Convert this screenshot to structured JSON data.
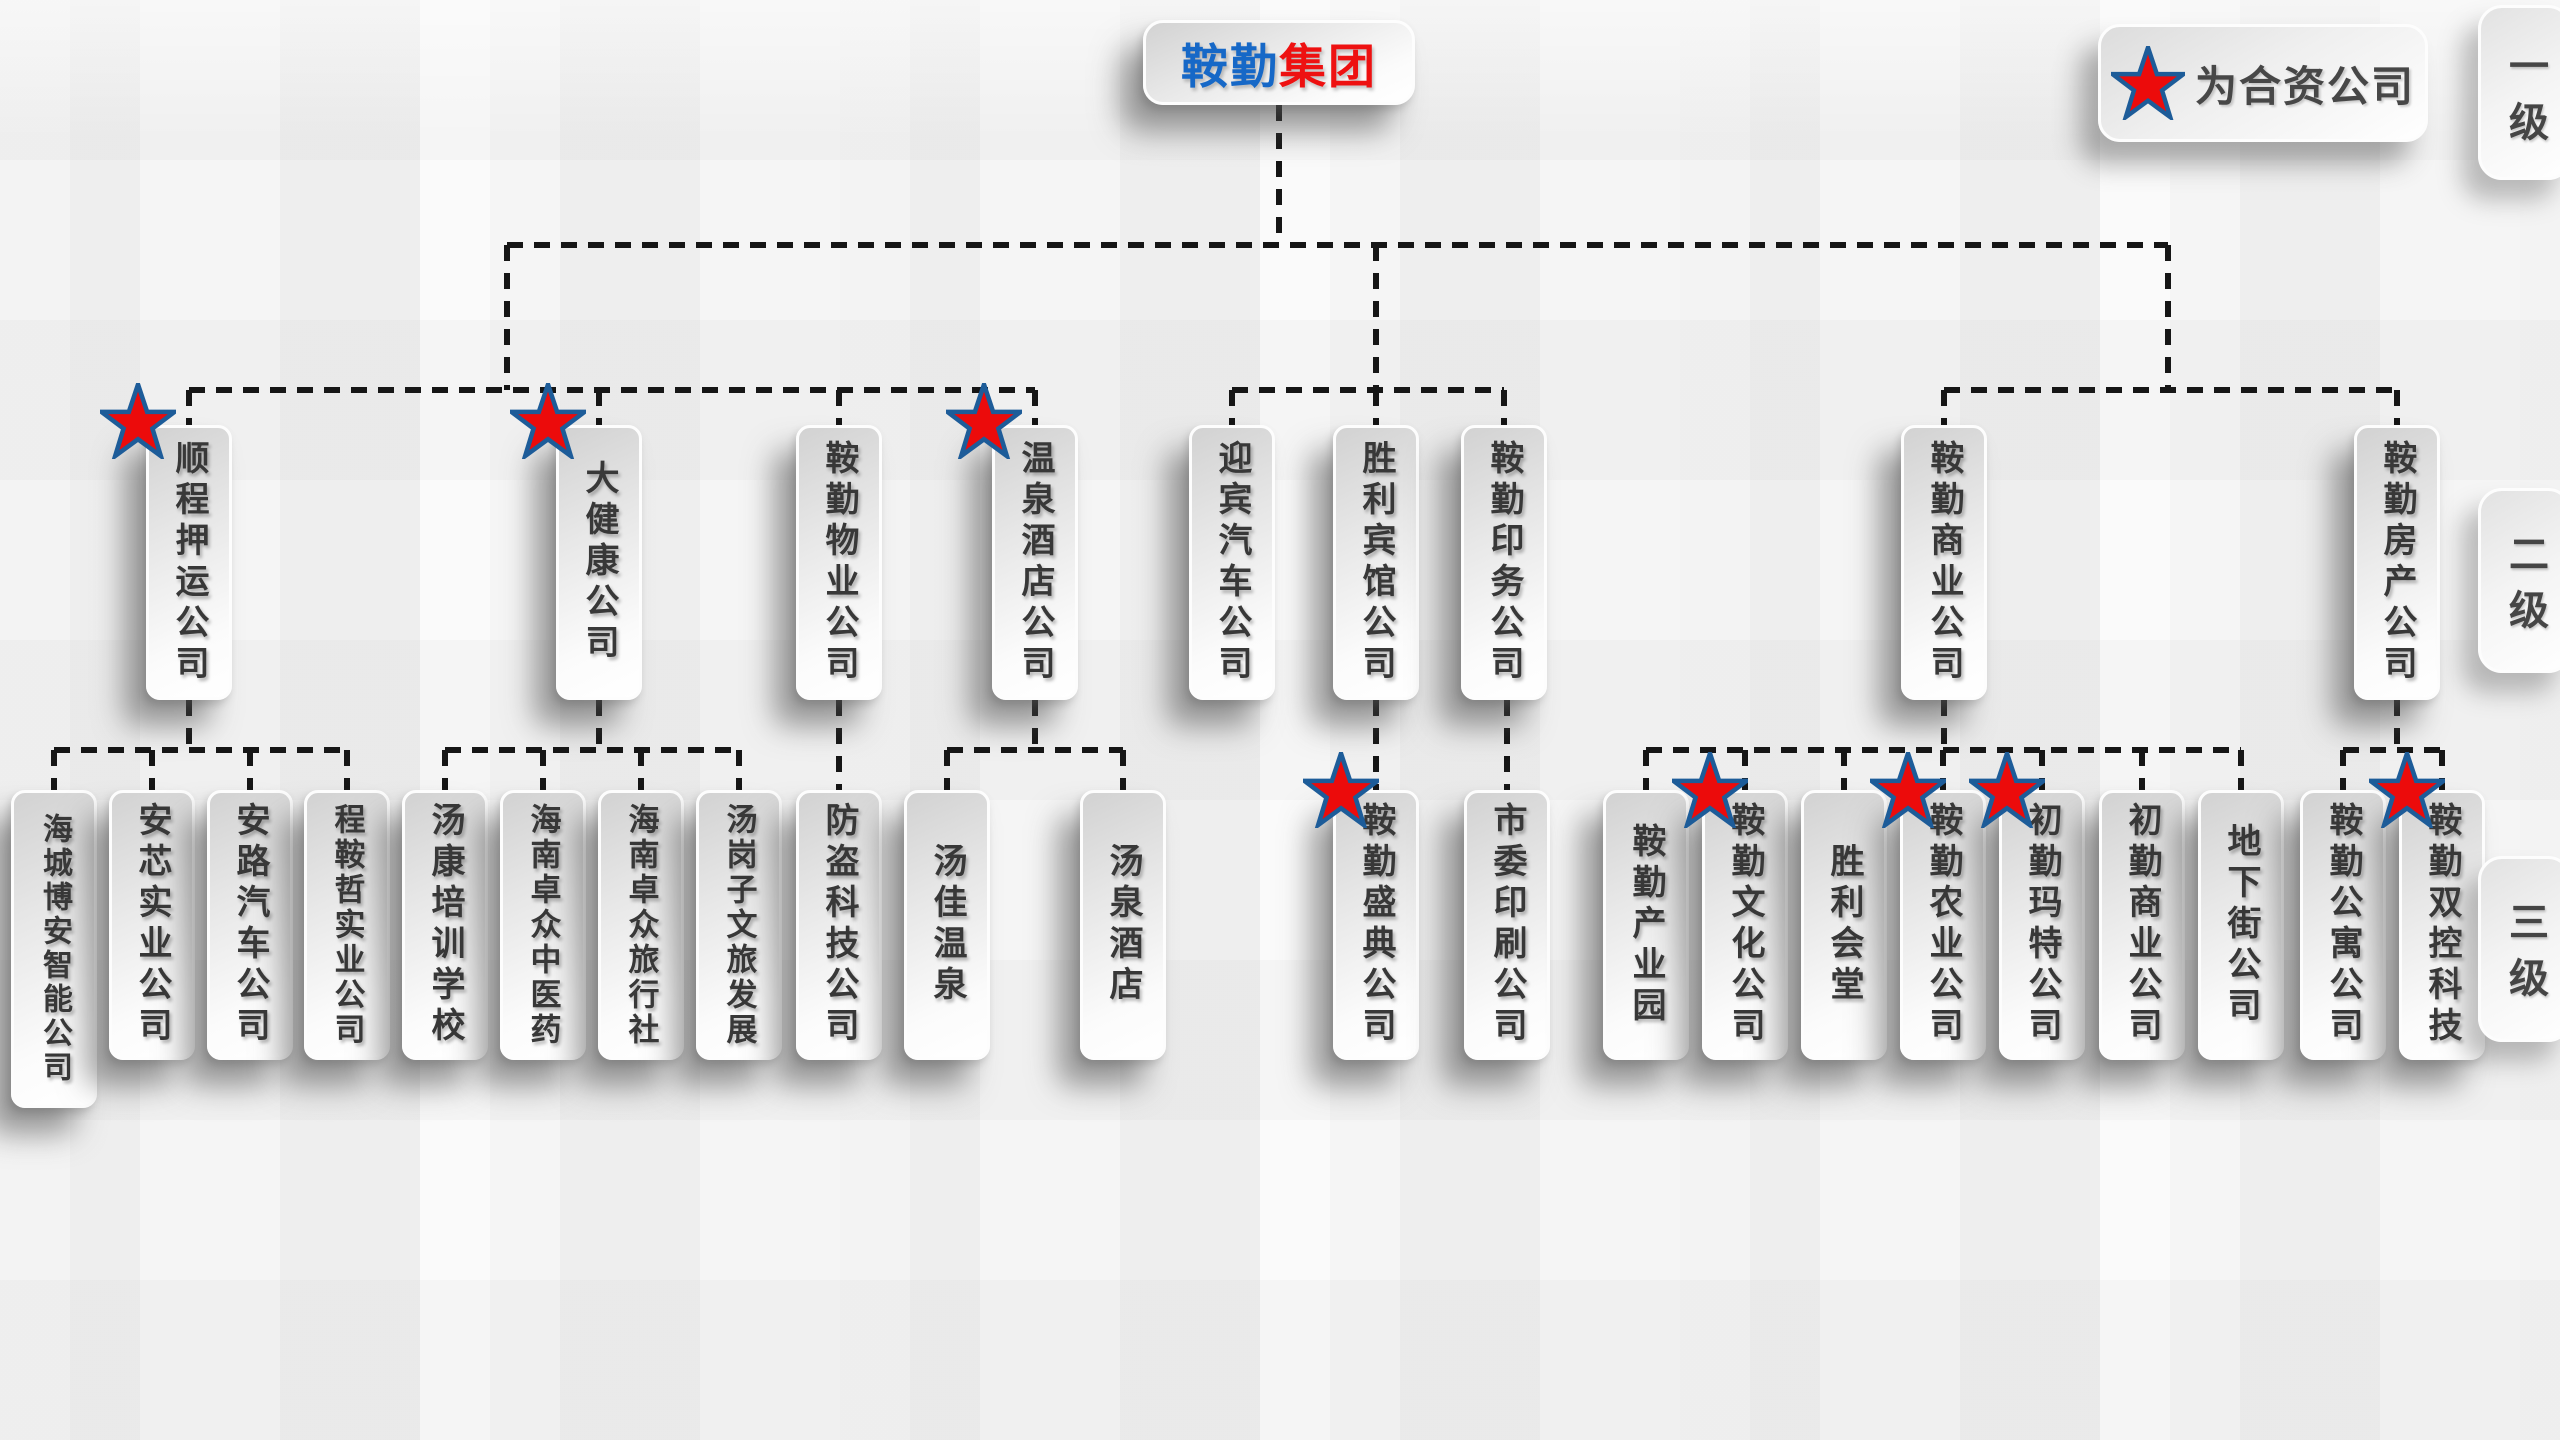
{
  "title": {
    "primary": "鞍勤",
    "secondary": "集团"
  },
  "legend": {
    "label": "为合资公司"
  },
  "tabs": [
    {
      "label": "一级"
    },
    {
      "label": "二级"
    },
    {
      "label": "三级"
    }
  ],
  "colors": {
    "title_primary": "#1668c7",
    "title_secondary": "#ee1111",
    "star_fill": "#ec0b0b",
    "star_stroke": "#1d5c99",
    "node_text": "#383838",
    "line": "#161616"
  },
  "level2": [
    {
      "label": "顺程押运公司",
      "star": true,
      "cx": 189
    },
    {
      "label": "大健康公司",
      "star": true,
      "cx": 599
    },
    {
      "label": "鞍勤物业公司",
      "star": false,
      "cx": 839
    },
    {
      "label": "温泉酒店公司",
      "star": true,
      "cx": 1035
    },
    {
      "label": "迎宾汽车公司",
      "star": false,
      "cx": 1232
    },
    {
      "label": "胜利宾馆公司",
      "star": false,
      "cx": 1376
    },
    {
      "label": "鞍勤印务公司",
      "star": false,
      "cx": 1504
    },
    {
      "label": "鞍勤商业公司",
      "star": false,
      "cx": 1944
    },
    {
      "label": "鞍勤房产公司",
      "star": false,
      "cx": 2397
    }
  ],
  "level3": [
    {
      "label": "海城博安智能公司",
      "star": false,
      "parent": 0,
      "cx": 54,
      "h": 318
    },
    {
      "label": "安芯实业公司",
      "star": false,
      "parent": 0,
      "cx": 152
    },
    {
      "label": "安路汽车公司",
      "star": false,
      "parent": 0,
      "cx": 250
    },
    {
      "label": "程鞍哲实业公司",
      "star": false,
      "parent": 0,
      "cx": 347
    },
    {
      "label": "汤康培训学校",
      "star": false,
      "parent": 1,
      "cx": 445
    },
    {
      "label": "海南卓众中医药",
      "star": false,
      "parent": 1,
      "cx": 543
    },
    {
      "label": "海南卓众旅行社",
      "star": false,
      "parent": 1,
      "cx": 641
    },
    {
      "label": "汤岗子文旅发展",
      "star": false,
      "parent": 1,
      "cx": 739
    },
    {
      "label": "防盗科技公司",
      "star": false,
      "parent": 2,
      "cx": 839
    },
    {
      "label": "汤佳温泉",
      "star": false,
      "parent": 3,
      "cx": 947
    },
    {
      "label": "汤泉酒店",
      "star": false,
      "parent": 3,
      "cx": 1123
    },
    {
      "label": "鞍勤盛典公司",
      "star": true,
      "parent": 5,
      "cx": 1376
    },
    {
      "label": "市委印刷公司",
      "star": false,
      "parent": 6,
      "cx": 1507
    },
    {
      "label": "鞍勤产业园",
      "star": false,
      "parent": 7,
      "cx": 1646
    },
    {
      "label": "鞍勤文化公司",
      "star": true,
      "parent": 7,
      "cx": 1745
    },
    {
      "label": "胜利会堂",
      "star": false,
      "parent": 7,
      "cx": 1844
    },
    {
      "label": "鞍勤农业公司",
      "star": true,
      "parent": 7,
      "cx": 1943
    },
    {
      "label": "初勤玛特公司",
      "star": true,
      "parent": 7,
      "cx": 2042
    },
    {
      "label": "初勤商业公司",
      "star": false,
      "parent": 7,
      "cx": 2142
    },
    {
      "label": "地下街公司",
      "star": false,
      "parent": 7,
      "cx": 2241
    },
    {
      "label": "鞍勤公寓公司",
      "star": false,
      "parent": 8,
      "cx": 2343
    },
    {
      "label": "鞍勤双控科技",
      "star": true,
      "parent": 8,
      "cx": 2442
    }
  ],
  "clusters": [
    {
      "riser_x": 507,
      "parents": [
        0,
        1,
        2,
        3
      ]
    },
    {
      "riser_x": 1376,
      "parents": [
        4,
        5,
        6
      ]
    },
    {
      "riser_x": 2168,
      "parents": [
        7,
        8
      ]
    }
  ]
}
